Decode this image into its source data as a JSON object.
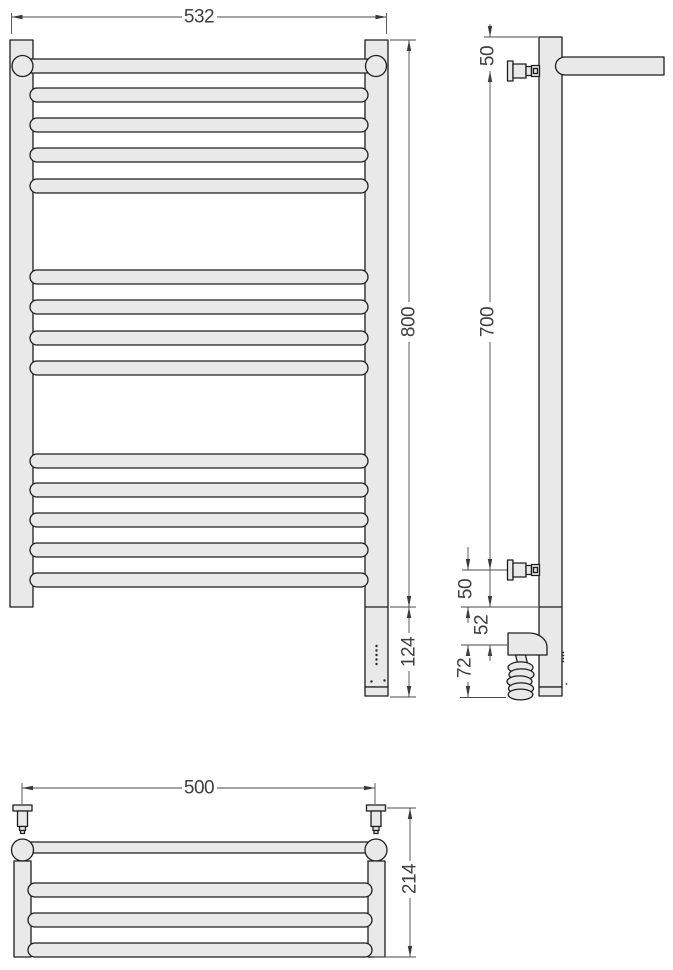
{
  "drawing": {
    "colors": {
      "body_fill": "#e9e9e9",
      "outline": "#1d1d1d",
      "dimension_line": "#4a4a4a",
      "dimension_text": "#3f3f3f",
      "background": "#ffffff"
    },
    "front_view": {
      "width": "532",
      "height": "800",
      "heater_section": "124"
    },
    "side_view": {
      "top_offset": "50",
      "bracket_span": "700",
      "bottom_offset": "50",
      "coupling": "52",
      "heater_protrusion": "72"
    },
    "top_view": {
      "width": "500",
      "depth": "214"
    }
  }
}
